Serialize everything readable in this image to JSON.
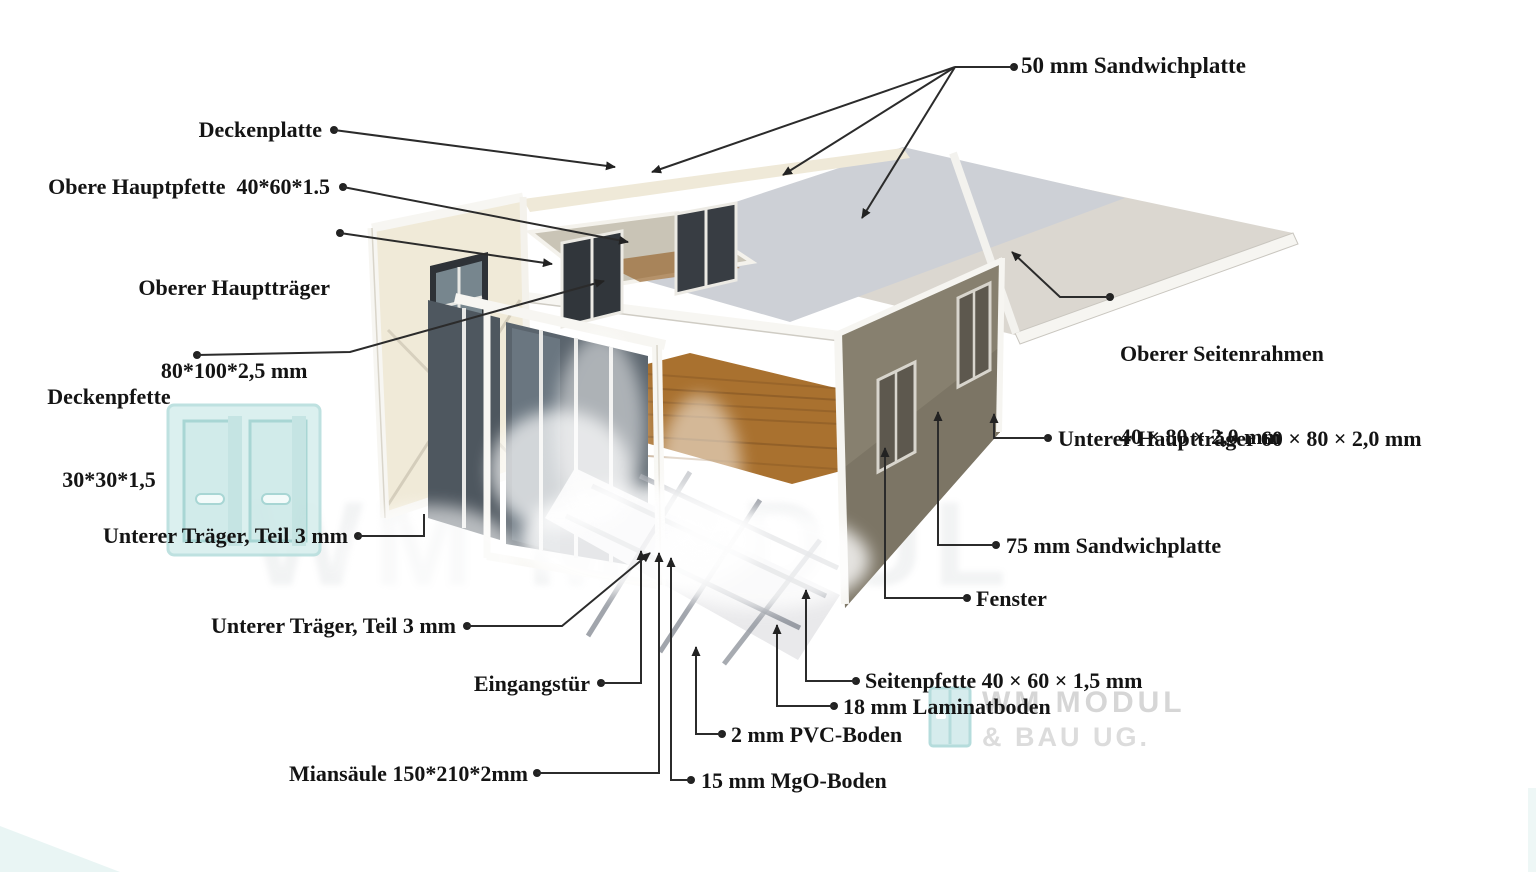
{
  "page": {
    "width": 1536,
    "height": 872,
    "background": "#ffffff"
  },
  "diagram_subject": "Expandable container house exploded-view diagram",
  "labels": {
    "sandwichplatte_50": "50 mm Sandwichplatte",
    "deckenplatte": "Deckenplatte",
    "obere_hauptpfette": "Obere Hauptpfette  40*60*1.5",
    "oberer_haupttraeger_line1": "Oberer Hauptträger",
    "oberer_haupttraeger_line2": "80*100*2,5 mm",
    "deckenpfette_line1": "Deckenpfette",
    "deckenpfette_line2": "30*30*1,5",
    "oberer_seitenrahmen_line1": "Oberer Seitenrahmen",
    "oberer_seitenrahmen_line2": "40 × 80 × 2,0 mm",
    "unterer_haupttraeger": "Unterer Hauptträger 60 × 80 × 2,0 mm",
    "sandwichplatte_75": "75 mm Sandwichplatte",
    "fenster": "Fenster",
    "unterer_traeger_1": "Unterer Träger, Teil 3 mm",
    "unterer_traeger_2": "Unterer Träger, Teil 3 mm",
    "eingangstuer": "Eingangstür",
    "seitenpfette": "Seitenpfette 40 × 60 × 1,5 mm",
    "laminatboden": "18 mm Laminatboden",
    "pvc_boden": "2 mm PVC-Boden",
    "mgo_boden": "15 mm MgO-Boden",
    "miansaeule": "Miansäule 150*210*2mm"
  },
  "watermark": {
    "logo_line1": "WM MODUL",
    "logo_line2": "& BAU UG.",
    "ghost": "WM MODUL"
  },
  "colors": {
    "label_text": "#141414",
    "leader_line": "#2b2b2b",
    "roof_center": "#cdd0d6",
    "roof_right": "#dbd7d0",
    "wall_cream": "#f0ead8",
    "wall_dark": "#87806f",
    "window_dark": "#33383d",
    "wood_floor": "#a9712f",
    "frame_white": "#f7f6f2",
    "joist_gray": "#8a8f98",
    "watermark_teal": "#d8efee",
    "watermark_logo_gray": "#d6d6d6"
  }
}
